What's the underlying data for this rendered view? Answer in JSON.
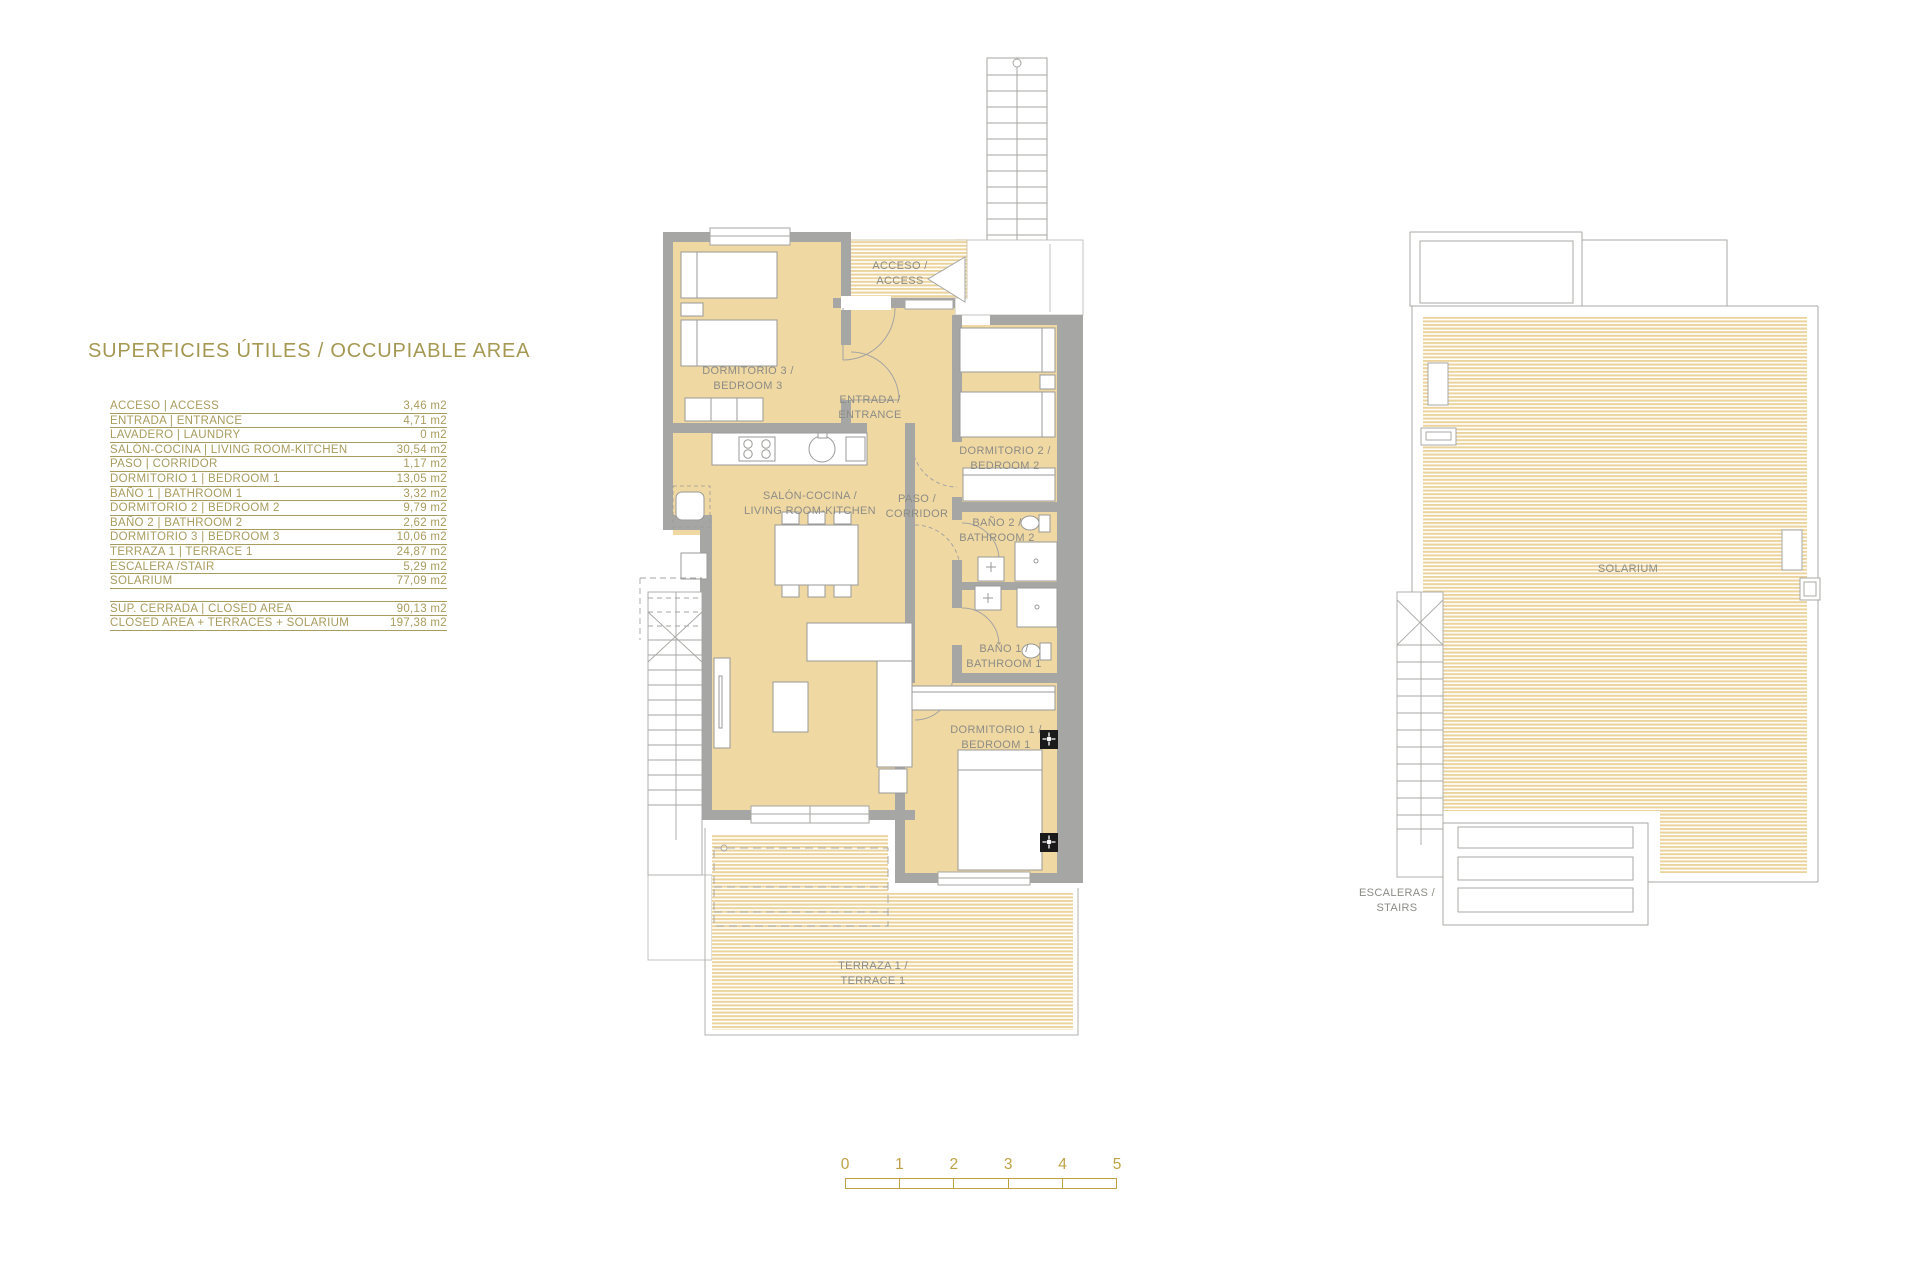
{
  "document": {
    "title": "SUPERFICIES ÚTILES / OCCUPIABLE AREA"
  },
  "area_table": {
    "rows": [
      {
        "label": "ACCESO | ACCESS",
        "value": "3,46 m2"
      },
      {
        "label": "ENTRADA | ENTRANCE",
        "value": "4,71 m2"
      },
      {
        "label": "LAVADERO | LAUNDRY",
        "value": "0 m2"
      },
      {
        "label": "SALÓN-COCINA | LIVING ROOM-KITCHEN",
        "value": "30,54 m2"
      },
      {
        "label": "PASO | CORRIDOR",
        "value": "1,17 m2"
      },
      {
        "label": "DORMITORIO 1 | BEDROOM 1",
        "value": "13,05 m2"
      },
      {
        "label": "BAÑO 1 | BATHROOM 1",
        "value": "3,32 m2"
      },
      {
        "label": "DORMITORIO 2 | BEDROOM 2",
        "value": "9,79 m2"
      },
      {
        "label": "BAÑO 2 | BATHROOM 2",
        "value": "2,62 m2"
      },
      {
        "label": "DORMITORIO 3 | BEDROOM 3",
        "value": "10,06 m2"
      },
      {
        "label": "TERRAZA 1 | TERRACE 1",
        "value": "24,87 m2"
      },
      {
        "label": "ESCALERA /STAIR",
        "value": "5,29 m2"
      },
      {
        "label": "SOLARIUM",
        "value": "77,09 m2"
      }
    ],
    "summary_rows": [
      {
        "label": "SUP. CERRADA | CLOSED AREA",
        "value": "90,13 m2"
      },
      {
        "label": "CLOSED AREA + TERRACES + SOLARIUM",
        "value": "197,38 m2"
      }
    ]
  },
  "plan_labels": {
    "acceso": {
      "l1": "ACCESO /",
      "l2": "ACCESS"
    },
    "dormitorio3": {
      "l1": "DORMITORIO 3 /",
      "l2": "BEDROOM 3"
    },
    "entrada": {
      "l1": "ENTRADA /",
      "l2": "ENTRANCE"
    },
    "dormitorio2": {
      "l1": "DORMITORIO 2 /",
      "l2": "BEDROOM 2"
    },
    "salon": {
      "l1": "SALÓN-COCINA /",
      "l2": "LIVING ROOM-KITCHEN"
    },
    "paso": {
      "l1": "PASO /",
      "l2": "CORRIDOR"
    },
    "bano2": {
      "l1": "BAÑO 2 /",
      "l2": "BATHROOM 2"
    },
    "bano1": {
      "l1": "BAÑO 1 /",
      "l2": "BATHROOM 1"
    },
    "dormitorio1": {
      "l1": "DORMITORIO 1 /",
      "l2": "BEDROOM 1"
    },
    "terraza": {
      "l1": "TERRAZA 1 /",
      "l2": "TERRACE 1"
    },
    "solarium": {
      "l1": "SOLARIUM"
    },
    "escaleras": {
      "l1": "ESCALERAS /",
      "l2": "STAIRS"
    }
  },
  "scale_bar": {
    "ticks": [
      "0",
      "1",
      "2",
      "3",
      "4",
      "5"
    ]
  },
  "colors": {
    "accent_gold": "#a89c5e",
    "scale_gold": "#bfa145",
    "wall_gray": "#a6a6a4",
    "room_fill": "#f0d8a2",
    "deck_stripe": "#ebd39b",
    "label_gray": "#8c8c86"
  }
}
